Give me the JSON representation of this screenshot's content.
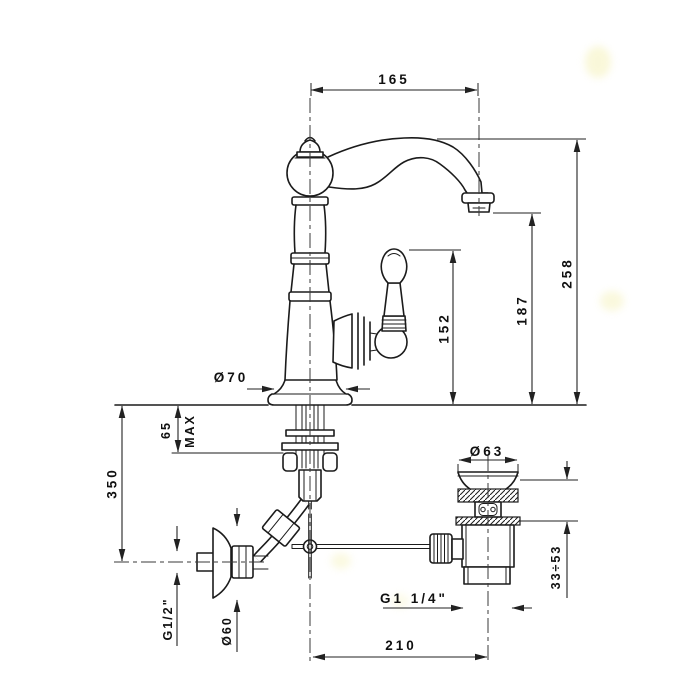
{
  "meta": {
    "description": "Technical installation drawing of a single-hole classic basin mixer tap with wall supply elbow and pop-up waste, with millimetre dimensions"
  },
  "colors": {
    "line": "#1b1b1b",
    "background": "#ffffff"
  },
  "dims": {
    "spout_reach": "165",
    "total_height": "258",
    "spout_height": "187",
    "handle_height": "152",
    "base_diameter": "Ø70",
    "deck_thickness": "65",
    "deck_thickness_max": "MAX",
    "supply_drop": "350",
    "supply_thread": "G1/2\"",
    "escutcheon_diameter": "Ø60",
    "waste_flange_diameter": "Ø63",
    "waste_clamp_range": "33÷53",
    "waste_thread": "G1 1/4\"",
    "centre_distance": "210"
  }
}
